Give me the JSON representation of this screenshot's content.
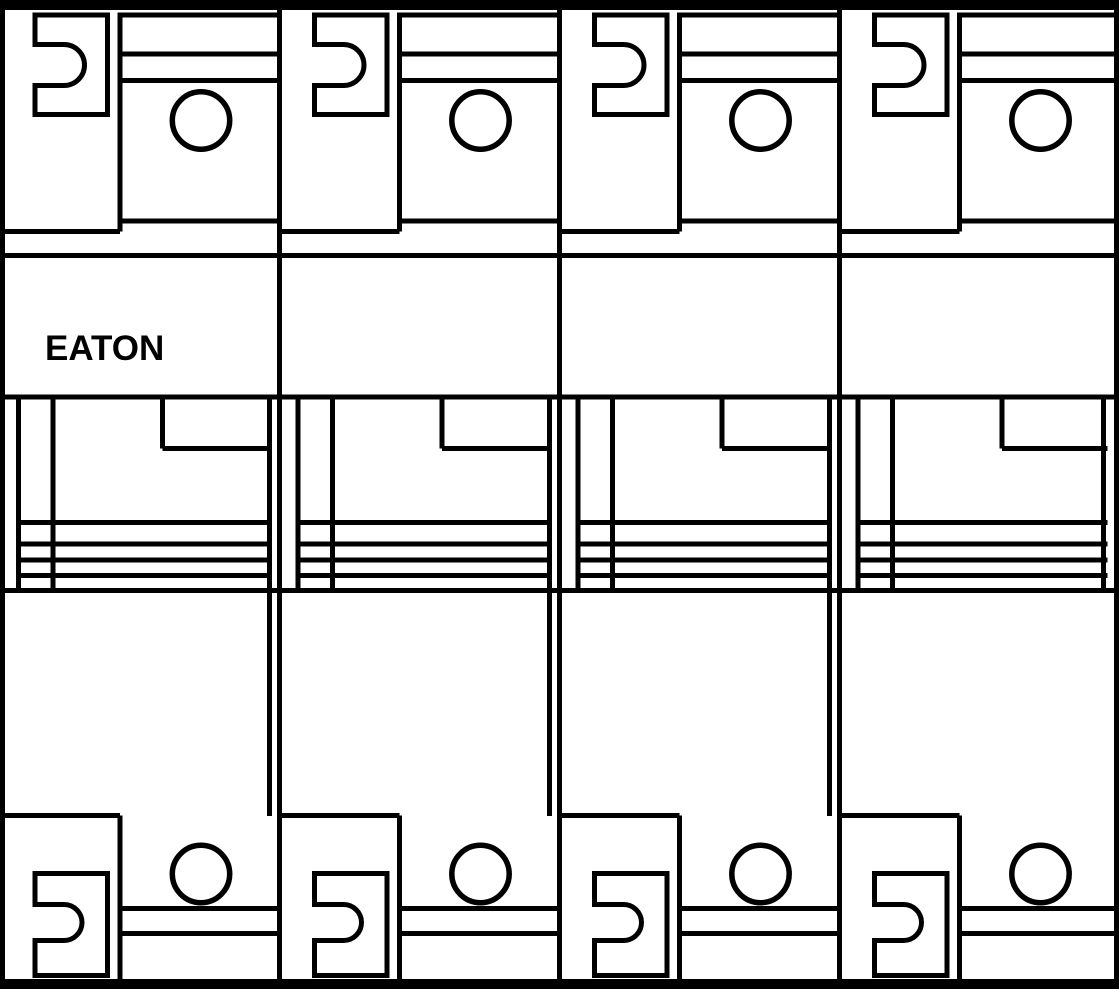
{
  "meta": {
    "title": "EATON 4-pole modular circuit breaker - front view line drawing",
    "diagram_type": "technical line drawing",
    "background_color": "#ffffff",
    "line_color": "#000000"
  },
  "brand": {
    "label": "EATON"
  },
  "breaker": {
    "pole_count": 4,
    "poles": [
      {
        "id": "pole-1",
        "has_brand_label": true
      },
      {
        "id": "pole-2",
        "has_brand_label": false
      },
      {
        "id": "pole-3",
        "has_brand_label": false
      },
      {
        "id": "pole-4",
        "has_brand_label": false
      }
    ],
    "pole_parts": [
      "din-rail-clip-top",
      "terminal-screw-top",
      "terminal-cover-top",
      "brand-plate-band",
      "toggle-face",
      "toggle-grip-lines",
      "terminal-screw-bottom",
      "din-rail-clip-bottom"
    ],
    "toggle_grip_line_count": 4
  }
}
